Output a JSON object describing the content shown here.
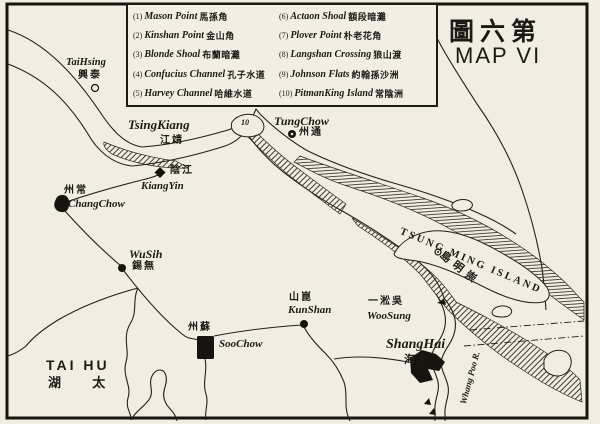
{
  "title": {
    "zh": "圖六第",
    "en": "MAP VI"
  },
  "legend": {
    "items": [
      {
        "num": "(1)",
        "name": "Mason Point",
        "zh": "馬孫角"
      },
      {
        "num": "(2)",
        "name": "Kinshan Point",
        "zh": "金山角"
      },
      {
        "num": "(3)",
        "name": "Blonde Shoal",
        "zh": "布蘭暗灘"
      },
      {
        "num": "(4)",
        "name": "Confucius Channel",
        "zh": "孔子水道"
      },
      {
        "num": "(5)",
        "name": "Harvey Channel",
        "zh": "哈維水道"
      },
      {
        "num": "(6)",
        "name": "Actaon Shoal",
        "zh": "額段暗灘"
      },
      {
        "num": "(7)",
        "name": "Plover Point",
        "zh": "朴老花角"
      },
      {
        "num": "(8)",
        "name": "Langshan Crossing",
        "zh": "狼山渡"
      },
      {
        "num": "(9)",
        "name": "Johnson Flats",
        "zh": "約翰孫沙洲"
      },
      {
        "num": "(10)",
        "name": "PitmanKing Island",
        "zh": "常陰洲"
      }
    ]
  },
  "places": {
    "taihsing": {
      "en": "TaiHsing",
      "zh": "興泰"
    },
    "tsingkiang": {
      "en": "TsingKiang",
      "zh": "江靖"
    },
    "tungchow": {
      "en": "TungChow",
      "zh": "州通"
    },
    "kiangyin": {
      "en": "KiangYin",
      "zh": "陰江"
    },
    "changchow": {
      "en": "ChangChow",
      "zh": "州常"
    },
    "wusih": {
      "en": "WuSih",
      "zh": "錫無"
    },
    "soochow": {
      "en": "SooChow",
      "zh": "州蘇"
    },
    "kunshan": {
      "en": "KunShan",
      "zh": "山崑"
    },
    "woosung": {
      "en": "WooSung",
      "zh": "一淞吳"
    },
    "shanghai": {
      "en": "ShangHai",
      "zh": "海上"
    }
  },
  "water": {
    "tai_hu": {
      "en": "TAI HU",
      "zh": "湖 太"
    },
    "tsungming": {
      "en": "TSUNG MING ISLAND",
      "zh": "島明崇"
    },
    "whang_poo": {
      "en": "Whang Poo R."
    }
  },
  "map_numbers": {
    "pitman_island": "10"
  },
  "colors": {
    "ink": "#1d1a16",
    "paper": "#f1ede3"
  }
}
